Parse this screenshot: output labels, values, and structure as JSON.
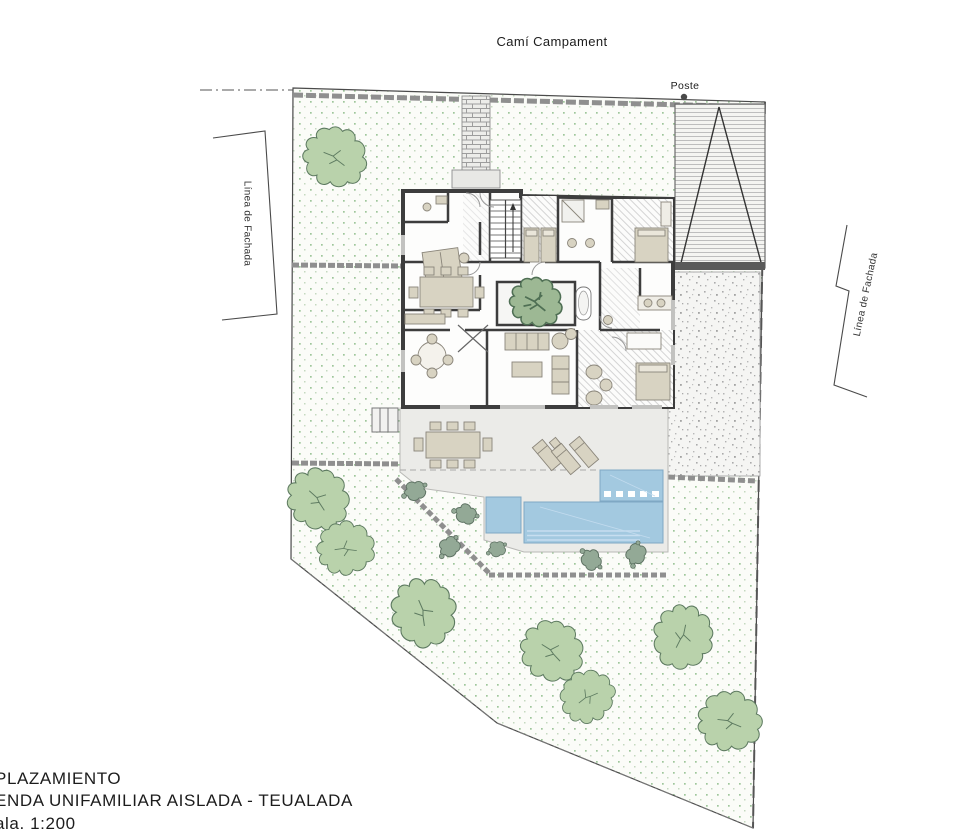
{
  "labels": {
    "street": "Camí Campament",
    "pole": "Poste",
    "facade_left": "Línea de Fachada",
    "facade_right": "Línea de Fachada"
  },
  "title_block": {
    "line1": "PLAZAMIENTO",
    "line2": "ENDA UNIFAMILIAR AISLADA - TEUALADA",
    "line3": "ala. 1:200"
  },
  "drawing": {
    "type": "site-plan",
    "scale": "1:200",
    "features": [
      "house-floor-plan",
      "swimming-pool",
      "terrace",
      "garden-trees",
      "entry-path",
      "neighbor-roof",
      "gravel-area",
      "facade-lines"
    ]
  },
  "colors": {
    "pool": "#a3c9e0",
    "pool_edge": "#7fa8c4",
    "wall": "#3d3d3d",
    "furniture": "#d8d3c2",
    "tree_fill": "#b9d2ab",
    "tree_outline": "#5d7a60",
    "courtyard_tree": "#4f6f54",
    "bush": "#93a996",
    "grass_dot": "#9ec69b",
    "deck": "#ebebe8",
    "stone": "#8f8f8f",
    "hatch": "#d4d4d4",
    "text": "#1c1c1c"
  }
}
